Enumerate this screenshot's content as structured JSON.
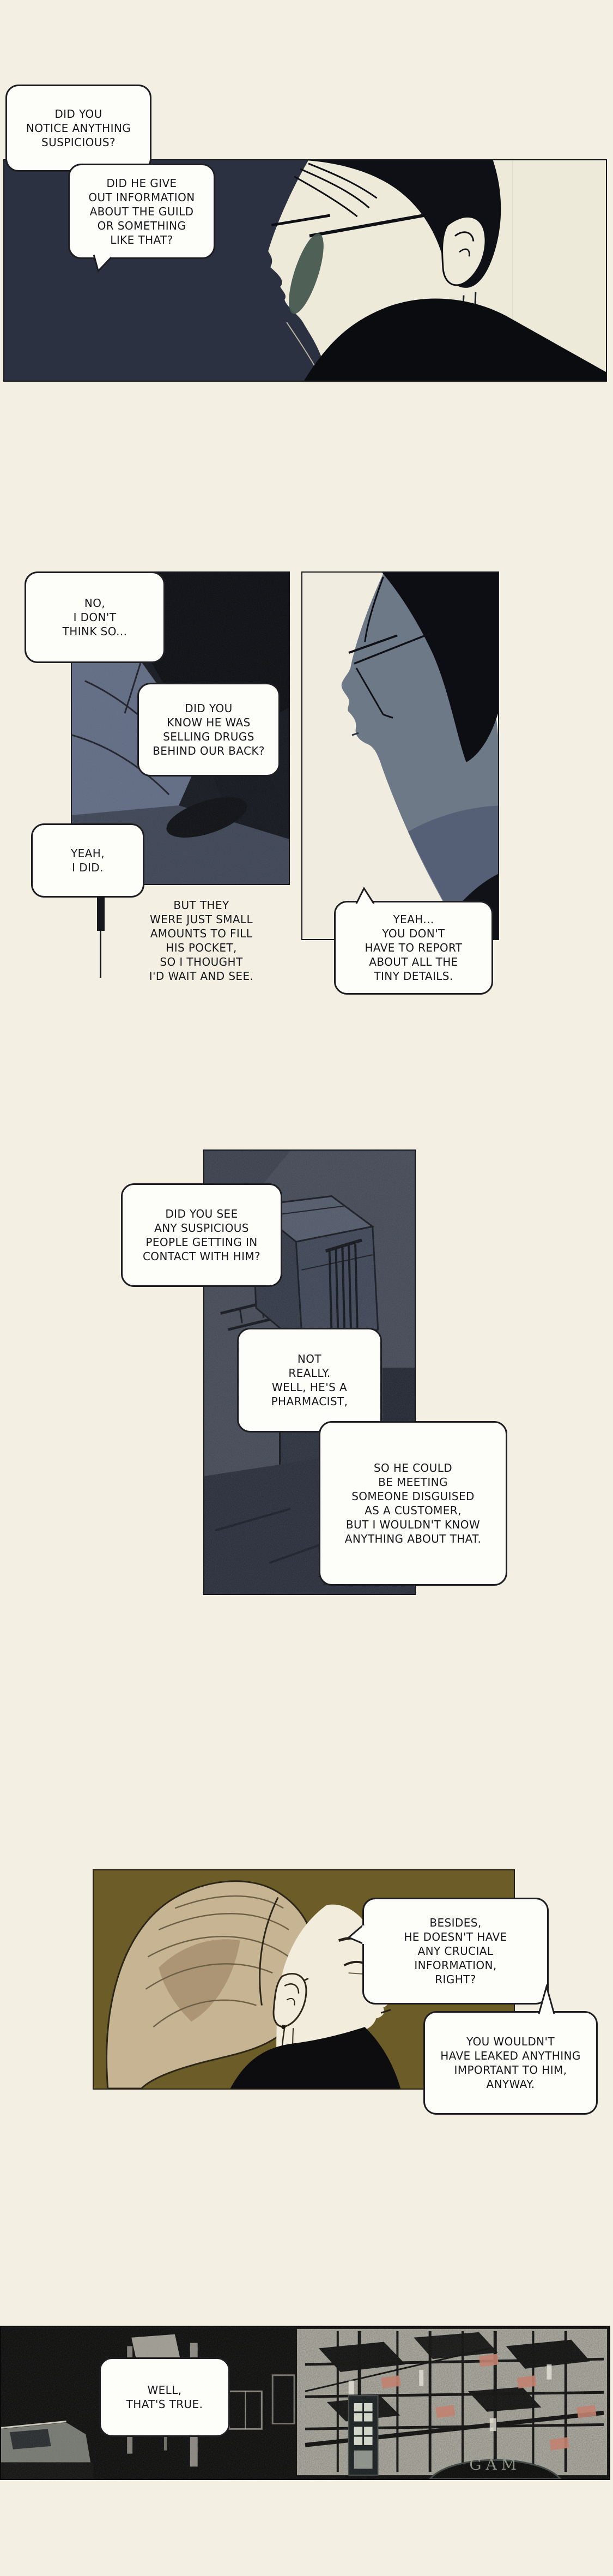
{
  "comic": {
    "bubbles": [
      {
        "id": 1,
        "text": "DID YOU\nNOTICE ANYTHING\nSUSPICIOUS?"
      },
      {
        "id": 2,
        "text": "DID HE GIVE\nOUT INFORMATION\nABOUT THE GUILD\nOR SOMETHING\nLIKE THAT?"
      },
      {
        "id": 3,
        "text": "NO,\nI DON'T\nTHINK SO..."
      },
      {
        "id": 4,
        "text": "DID YOU\nKNOW HE WAS\nSELLING DRUGS\nBEHIND OUR BACK?"
      },
      {
        "id": 5,
        "text": "YEAH,\nI DID."
      },
      {
        "id": 6,
        "text": "BUT THEY\nWERE JUST SMALL\nAMOUNTS TO FILL\nHIS POCKET,\nSO I THOUGHT\nI'D WAIT AND SEE."
      },
      {
        "id": 7,
        "text": "YEAH...\nYOU DON'T\nHAVE TO REPORT\nABOUT ALL THE\nTINY DETAILS."
      },
      {
        "id": 8,
        "text": "DID YOU SEE\nANY SUSPICIOUS\nPEOPLE GETTING IN\nCONTACT WITH HIM?"
      },
      {
        "id": 9,
        "text": "NOT\nREALLY.\nWELL, HE'S A\nPHARMACIST,"
      },
      {
        "id": 10,
        "text": "SO HE COULD\nBE MEETING\nSOMEONE DISGUISED\nAS A CUSTOMER,\nBUT I WOULDN'T KNOW\nANYTHING ABOUT THAT."
      },
      {
        "id": 11,
        "text": "BESIDES,\nHE DOESN'T HAVE\nANY CRUCIAL\nINFORMATION,\nRIGHT?"
      },
      {
        "id": 12,
        "text": "YOU WOULDN'T\nHAVE LEAKED ANYTHING\nIMPORTANT TO HIM,\nANYWAY."
      },
      {
        "id": 13,
        "text": "WELL,\nTHAT'S TRUE."
      }
    ],
    "sign_text": "GAM",
    "colors": {
      "page_bg": "#f3f0e3",
      "panel1_navy": "#2b3140",
      "panel1_cream": "#edead9",
      "lens_teal": "#47594f",
      "panel2_dark": "#13151c",
      "fabric_blue": "#5d6880",
      "face_blue_grey": "#6e7988",
      "panel3_grain": "#3e4450",
      "panel4_olive": "#6b5c28",
      "hair_tan": "#c7b493",
      "face_cream": "#f2ecdc",
      "city_texture": "#b7b5a8",
      "awning_pink": "#bf7a68",
      "ink_black": "#0f1016",
      "bubble_bg": "#fdfdfa",
      "bubble_border": "#1e1e22"
    }
  }
}
